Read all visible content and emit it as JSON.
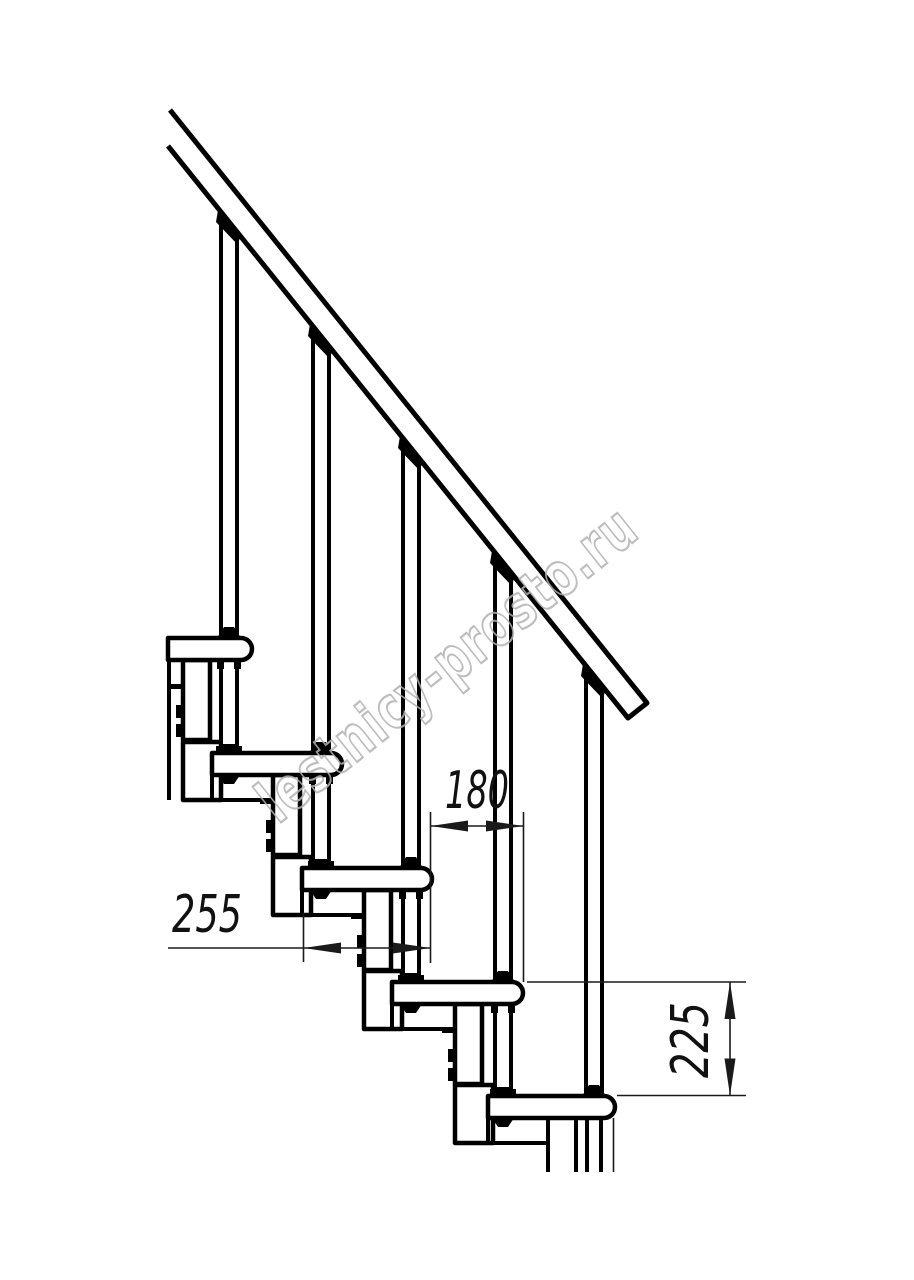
{
  "drawing": {
    "watermark_text": "lestnicy-prosto.ru",
    "dimensions": {
      "step_run": "180",
      "tread_depth": "255",
      "riser_height": "225"
    },
    "colors": {
      "line": "#000000",
      "dimension": "#1a1a1a",
      "watermark": "#b2b2b2",
      "background": "#ffffff"
    }
  }
}
